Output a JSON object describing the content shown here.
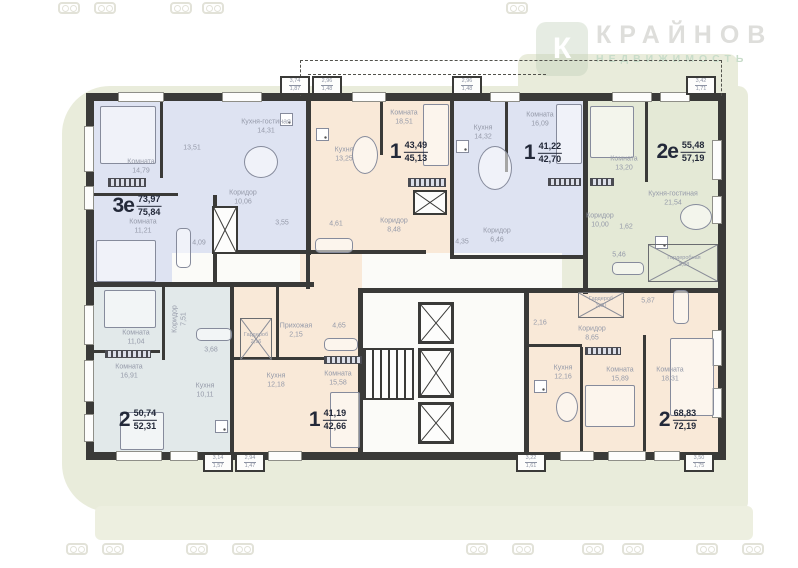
{
  "watermark": {
    "brand": "КРАЙНОВ",
    "tagline": "НЕДВИЖИМОСТЬ",
    "logo_glyph": "К"
  },
  "colors": {
    "wall": "#3a3a38",
    "lavender": "#dee3f2",
    "peach": "#f9e9d8",
    "green": "#e4e9d6",
    "bluegray": "#e2e9ea",
    "background": "#e9ecdb"
  },
  "apartments": [
    {
      "number": "3е",
      "area_main": "73,97",
      "area_total": "75,84",
      "rooms": [
        {
          "label": "Комната",
          "area": "14,79"
        },
        {
          "label": "",
          "area": "13,51"
        },
        {
          "label": "Кухня-гостиная",
          "area": "14,31"
        },
        {
          "label": "Комната",
          "area": "11,21"
        },
        {
          "label": "Коридор",
          "area": "10,06"
        },
        {
          "label": "",
          "area": "4,09"
        },
        {
          "label": "",
          "area": "3,55"
        }
      ]
    },
    {
      "number": "1",
      "area_main": "43,49",
      "area_total": "45,13",
      "rooms": [
        {
          "label": "Комната",
          "area": "18,51"
        },
        {
          "label": "Кухня",
          "area": "13,25"
        },
        {
          "label": "Коридор",
          "area": "8,48"
        },
        {
          "label": "",
          "area": "4,61"
        }
      ]
    },
    {
      "number": "1",
      "area_main": "41,22",
      "area_total": "42,70",
      "rooms": [
        {
          "label": "Комната",
          "area": "16,09"
        },
        {
          "label": "Кухня",
          "area": "14,32"
        },
        {
          "label": "Коридор",
          "area": "6,46"
        },
        {
          "label": "",
          "area": "4,35"
        }
      ]
    },
    {
      "number": "2е",
      "area_main": "55,48",
      "area_total": "57,19",
      "rooms": [
        {
          "label": "Комната",
          "area": "13,20"
        },
        {
          "label": "Кухня-гостиная",
          "area": "21,54"
        },
        {
          "label": "Коридор",
          "area": "10,00"
        },
        {
          "label": "",
          "area": "1,62"
        },
        {
          "label": "",
          "area": "5,46"
        },
        {
          "label": "Гардеробная",
          "area": "3,88"
        }
      ]
    },
    {
      "number": "2",
      "area_main": "50,74",
      "area_total": "52,31",
      "rooms": [
        {
          "label": "Комната",
          "area": "11,04"
        },
        {
          "label": "Комната",
          "area": "16,91"
        },
        {
          "label": "Коридор",
          "area": "7,51"
        },
        {
          "label": "Кухня",
          "area": "10,11"
        },
        {
          "label": "",
          "area": "3,68"
        }
      ]
    },
    {
      "number": "1",
      "area_main": "41,19",
      "area_total": "42,66",
      "rooms": [
        {
          "label": "Комната",
          "area": "15,58"
        },
        {
          "label": "Кухня",
          "area": "12,18"
        },
        {
          "label": "Прихожая",
          "area": "2,15"
        },
        {
          "label": "",
          "area": "4,65"
        },
        {
          "label": "Гардероб",
          "area": "2,16"
        }
      ]
    },
    {
      "number": "2",
      "area_main": "68,83",
      "area_total": "72,19",
      "rooms": [
        {
          "label": "Кухня",
          "area": "12,16"
        },
        {
          "label": "Комната",
          "area": "15,89"
        },
        {
          "label": "Комната",
          "area": "18,31"
        },
        {
          "label": "Коридор",
          "area": "8,65"
        },
        {
          "label": "",
          "area": "5,87"
        },
        {
          "label": "",
          "area": "2,16"
        },
        {
          "label": "Гардероб",
          "area": "3,30"
        }
      ]
    }
  ],
  "balconies": [
    {
      "a": "3,74",
      "b": "1,87"
    },
    {
      "a": "2,96",
      "b": "1,48"
    },
    {
      "a": "2,96",
      "b": "1,48"
    },
    {
      "a": "3,42",
      "b": "1,71"
    },
    {
      "a": "3,14",
      "b": "1,57"
    },
    {
      "a": "2,94",
      "b": "1,47"
    },
    {
      "a": "3,22",
      "b": "1,61"
    },
    {
      "a": "3,50",
      "b": "1,75"
    }
  ]
}
